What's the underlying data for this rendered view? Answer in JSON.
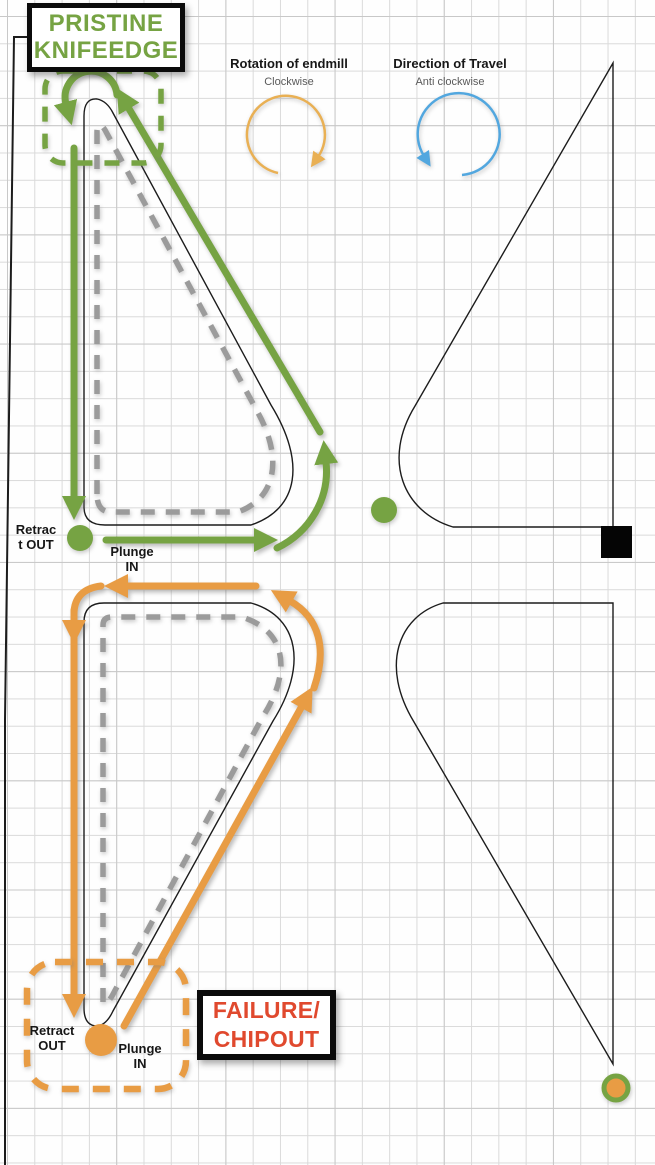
{
  "pristine_box": {
    "line1": "PRISTINE",
    "line2": "KNIFEEDGE"
  },
  "failure_box": {
    "line1": "FAILURE/",
    "line2": "CHIPOUT"
  },
  "legend": {
    "rotation_title": "Rotation of endmill",
    "rotation_subtitle": "Clockwise",
    "travel_title": "Direction of Travel",
    "travel_subtitle": "Anti clockwise"
  },
  "top_toolpath": {
    "retract_line1": "Retrac",
    "retract_line2": "t OUT",
    "plunge_line1": "Plunge",
    "plunge_line2": "IN"
  },
  "bottom_toolpath": {
    "retract_line1": "Retract",
    "retract_line2": "OUT",
    "plunge_line1": "Plunge",
    "plunge_line2": "IN"
  },
  "colors": {
    "pristine_green": "#76a343",
    "failure_red": "#e0492e",
    "toolpath_green": "#76a343",
    "toolpath_orange": "#e89c44",
    "rotation_circle_orange": "#e9b054",
    "travel_circle_blue": "#52a7df",
    "inner_toolpath_gray": "#9b9b9b",
    "outline_black": "#1c1c1c",
    "grid_gray": "#dadada"
  }
}
